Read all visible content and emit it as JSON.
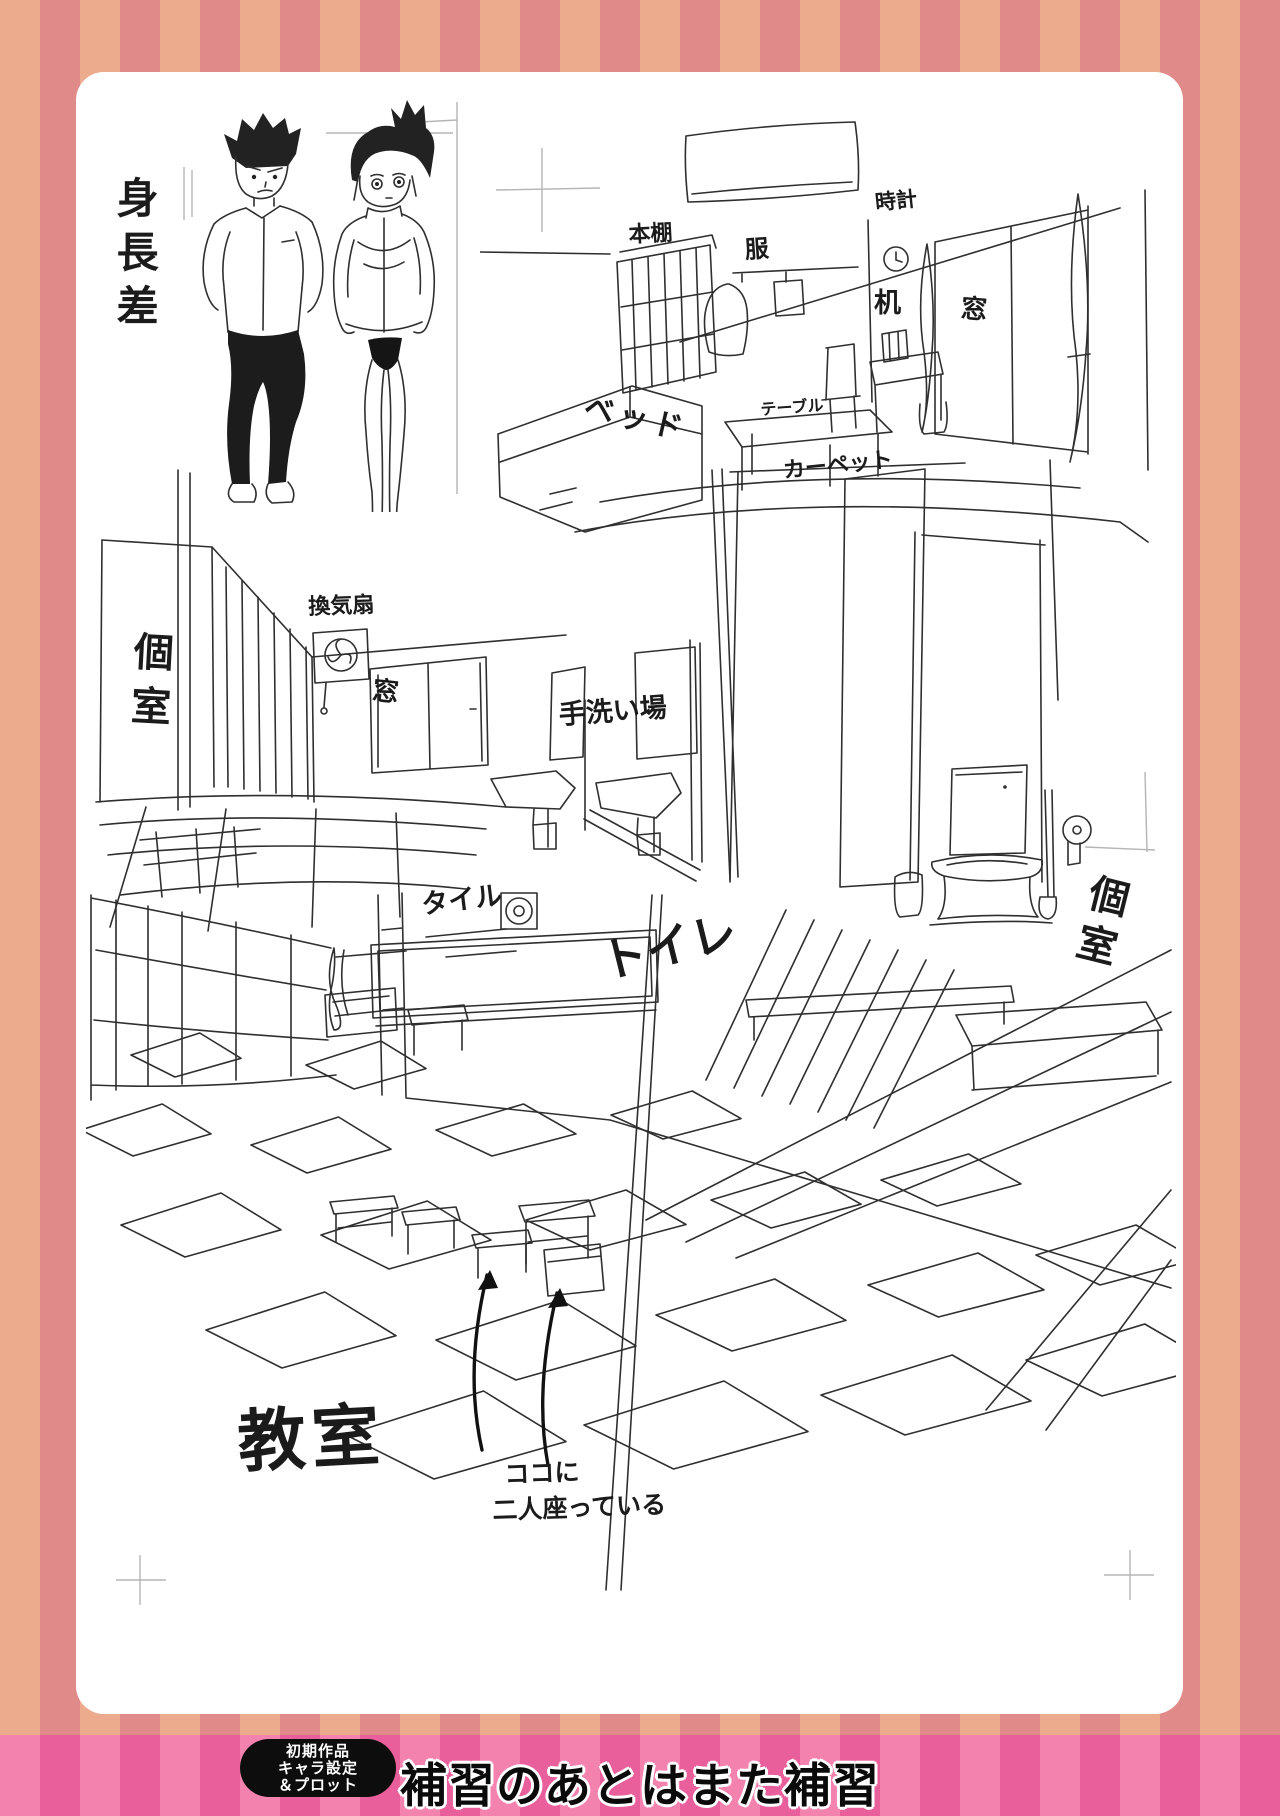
{
  "artbook_page": {
    "height_comparison_label": "身長差",
    "bedroom": {
      "bookshelf": "本棚",
      "clothes": "服",
      "clock": "時計",
      "desk": "机",
      "window": "窓",
      "bed": "ベッド",
      "table": "テーブル",
      "carpet": "カーペット"
    },
    "washroom": {
      "stall": "個室",
      "ventilation_fan": "換気扇",
      "window": "窓",
      "hand_wash_area": "手洗い場",
      "tile": "タイル",
      "toilet": "トイレ"
    },
    "toilet_room": {
      "stall": "個室"
    },
    "classroom": {
      "name": "教室",
      "seating_note_line1": "ココに",
      "seating_note_line2": "二人座っている"
    }
  },
  "footer": {
    "badge_line1": "初期作品",
    "badge_line2": "キャラ設定",
    "badge_line3": "＆プロット",
    "title": "補習のあとはまた補習"
  },
  "colors": {
    "stripe_peach": "#edab8e",
    "stripe_rose": "#e08a8a",
    "footer_pink_light": "#f382af",
    "footer_pink_dark": "#e95f9b",
    "page_bg": "#ffffff",
    "ink": "#2f2f2f"
  }
}
